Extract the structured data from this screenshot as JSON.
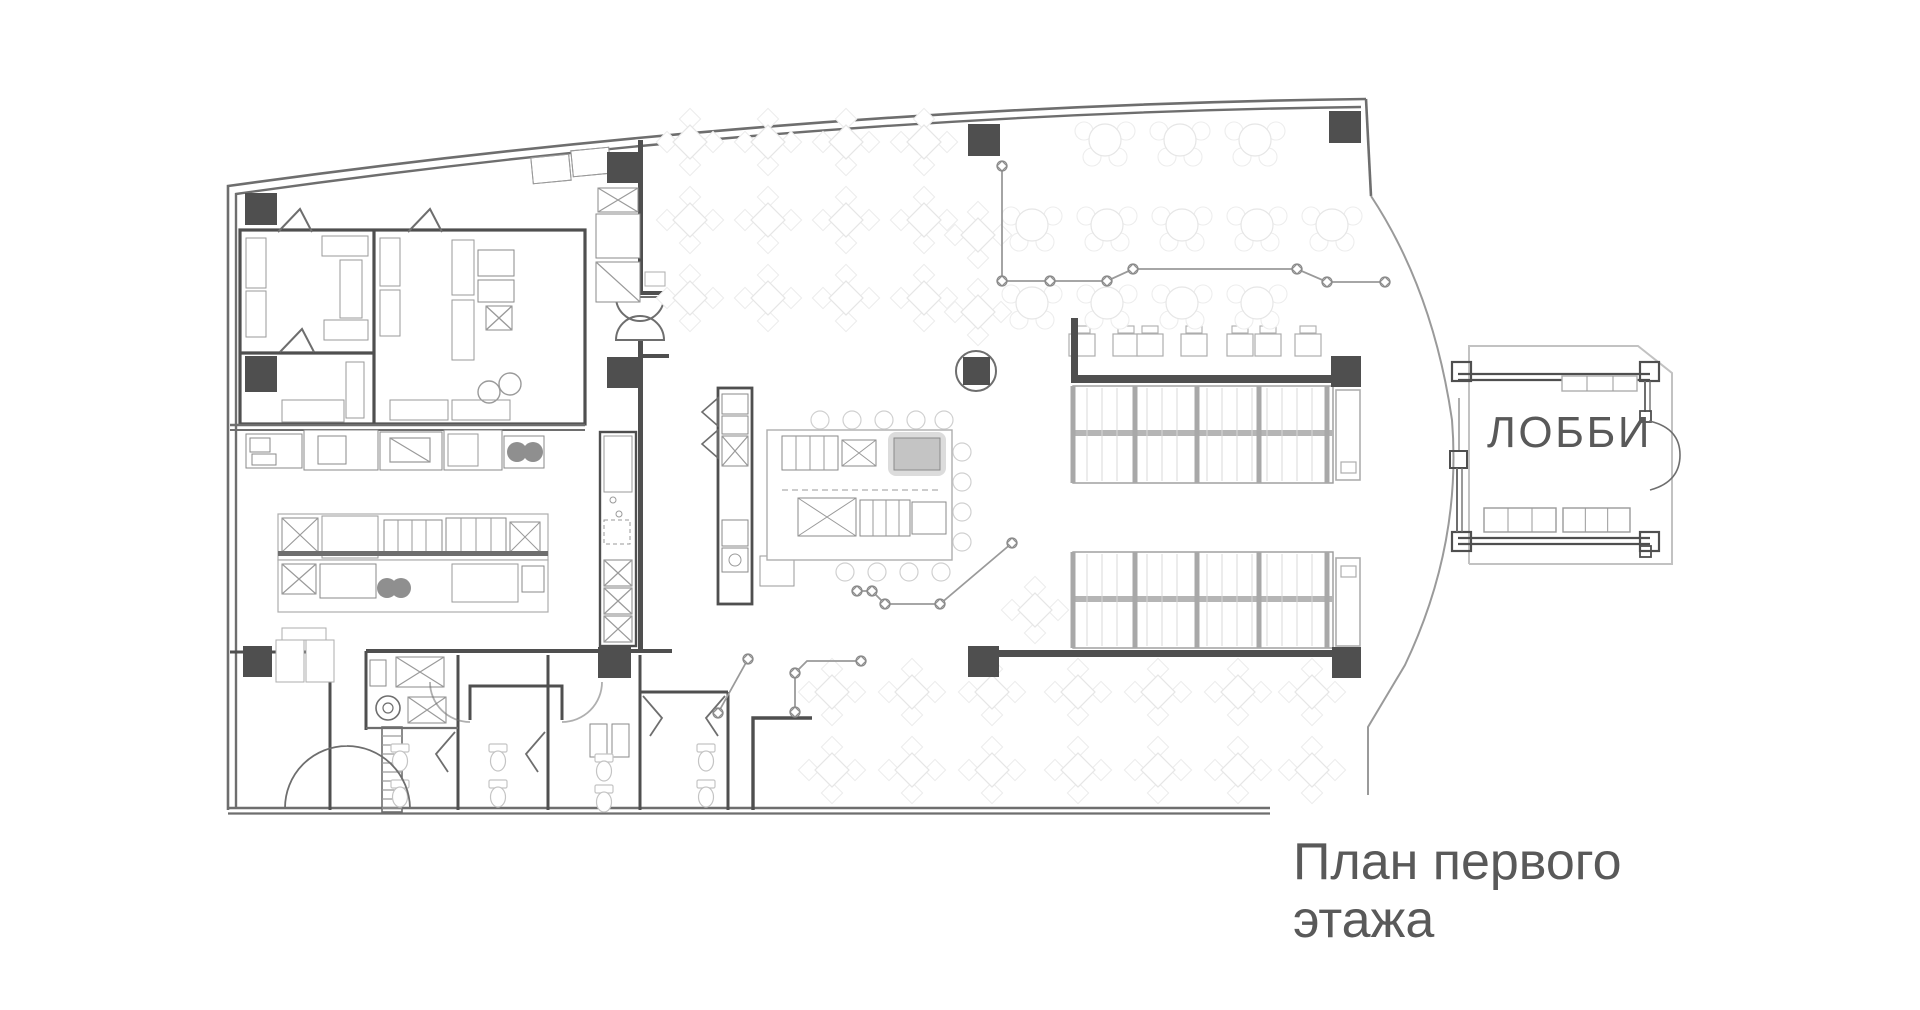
{
  "plan": {
    "room_labels": {
      "lobby": "ЛОББИ"
    },
    "caption": {
      "line1": "План первого",
      "line2": "этажа"
    },
    "colors": {
      "background": "#ffffff",
      "wall_dark": "#4f4f4f",
      "wall_medium": "#6e6e6e",
      "wall_light": "#9a9a9a",
      "equipment_gray": "#8a8a8a",
      "furniture_faint": "#e6e6e6",
      "text": "#595959"
    }
  }
}
